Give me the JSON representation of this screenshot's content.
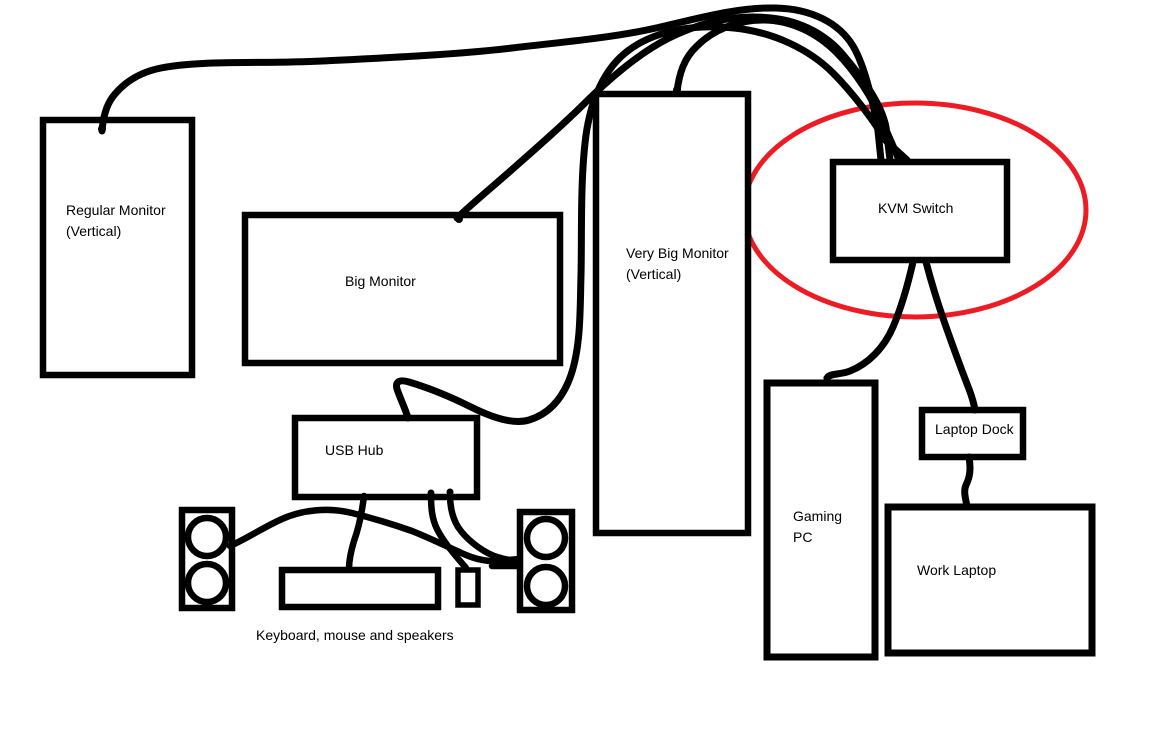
{
  "diagram": {
    "type": "hand-drawn wiring diagram",
    "background_color": "#ffffff",
    "stroke_color": "#000000",
    "nodes": {
      "regular_monitor": {
        "line1": "Regular Monitor",
        "line2": "(Vertical)"
      },
      "big_monitor": {
        "label": "Big Monitor"
      },
      "very_big_monitor": {
        "line1": "Very Big Monitor",
        "line2": "(Vertical)"
      },
      "kvm_switch": {
        "label": "KVM Switch"
      },
      "usb_hub": {
        "label": "USB Hub"
      },
      "gaming_pc": {
        "line1": "Gaming",
        "line2": "PC"
      },
      "laptop_dock": {
        "label": "Laptop Dock"
      },
      "work_laptop": {
        "label": "Work Laptop"
      },
      "keyboard": {
        "label": ""
      },
      "mouse": {
        "label": ""
      },
      "speaker_left": {
        "label": ""
      },
      "speaker_right": {
        "label": ""
      }
    },
    "caption": "Keyboard, mouse and speakers",
    "highlight": {
      "shape": "ellipse",
      "around": "KVM Switch",
      "color": "#ed1c24"
    },
    "connections": [
      {
        "from": "Regular Monitor (Vertical)",
        "to": "KVM Switch"
      },
      {
        "from": "Big Monitor",
        "to": "KVM Switch"
      },
      {
        "from": "Very Big Monitor (Vertical)",
        "to": "KVM Switch"
      },
      {
        "from": "USB Hub",
        "to": "KVM Switch"
      },
      {
        "from": "KVM Switch",
        "to": "Gaming PC"
      },
      {
        "from": "KVM Switch",
        "to": "Laptop Dock"
      },
      {
        "from": "Laptop Dock",
        "to": "Work Laptop"
      },
      {
        "from": "USB Hub",
        "to": "Keyboard"
      },
      {
        "from": "USB Hub",
        "to": "Mouse"
      },
      {
        "from": "USB Hub",
        "to": "Speaker (right)"
      },
      {
        "from": "Speaker (left)",
        "to": "Speaker (right)"
      }
    ]
  }
}
